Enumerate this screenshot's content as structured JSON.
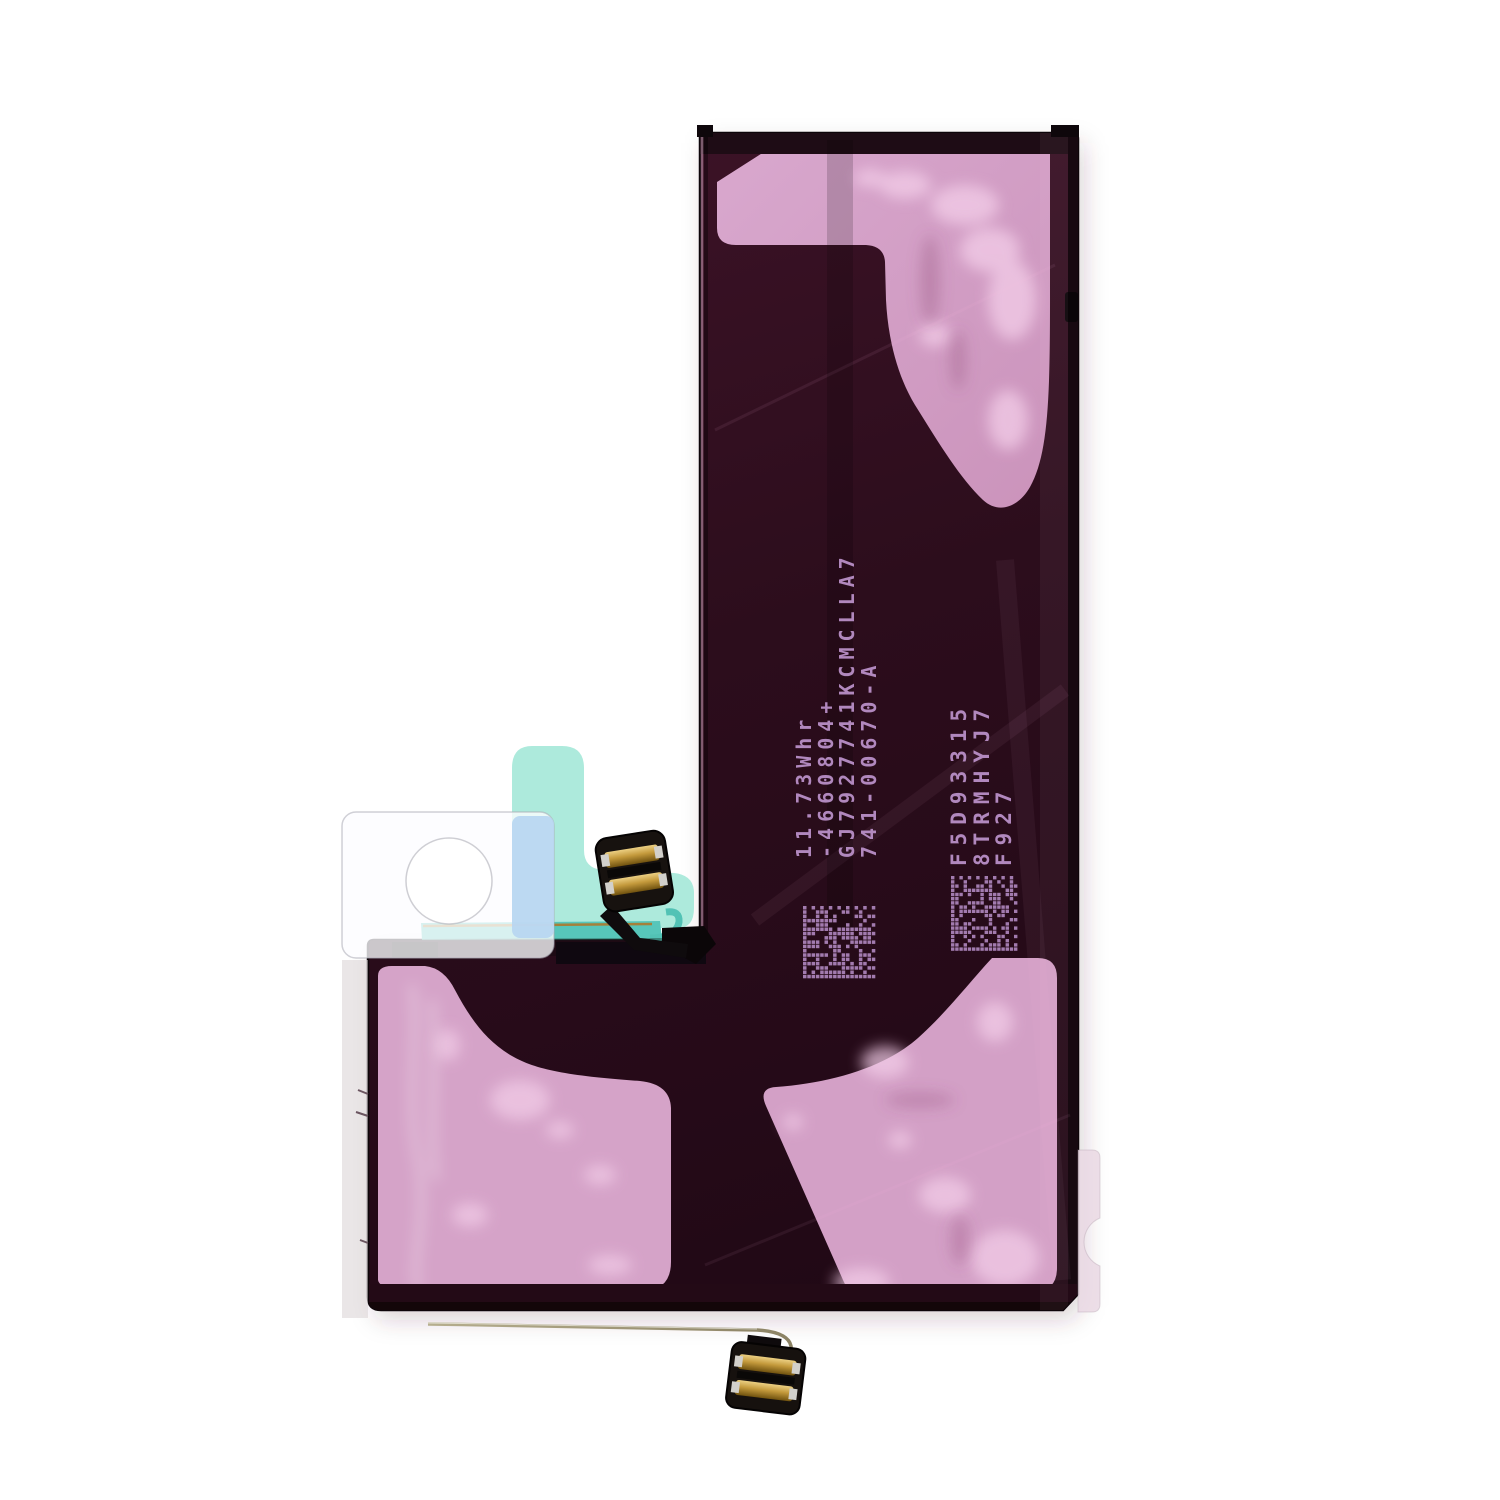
{
  "scene": {
    "background_color": "#ffffff",
    "subject": "L-shaped smartphone battery, adhesive side up"
  },
  "battery": {
    "colors": {
      "body": "#2c0d1c",
      "edge": "#140710",
      "adhesive_pink": "#d4a0c6",
      "adhesive_pink_light": "#f0cbe5",
      "pull_tab_mint": "#a9e9da",
      "pull_strip_teal": "#57c6ba",
      "film_white": "#f4f4f8",
      "film_blue_overlap": "#b7d5f1",
      "connector_body": "#17120f",
      "connector_contacts_gold": "#c9a23f",
      "wire": "#a79e7d",
      "print": "#bd93cc"
    },
    "markings": {
      "block1_lines": [
        "11.73Whr",
        "-4660804+",
        "GJ7927741KCMCLLA7",
        "741-00670-A"
      ],
      "block2_lines": [
        "F5D93315",
        "8TRMHYJ7",
        "F927"
      ]
    }
  }
}
